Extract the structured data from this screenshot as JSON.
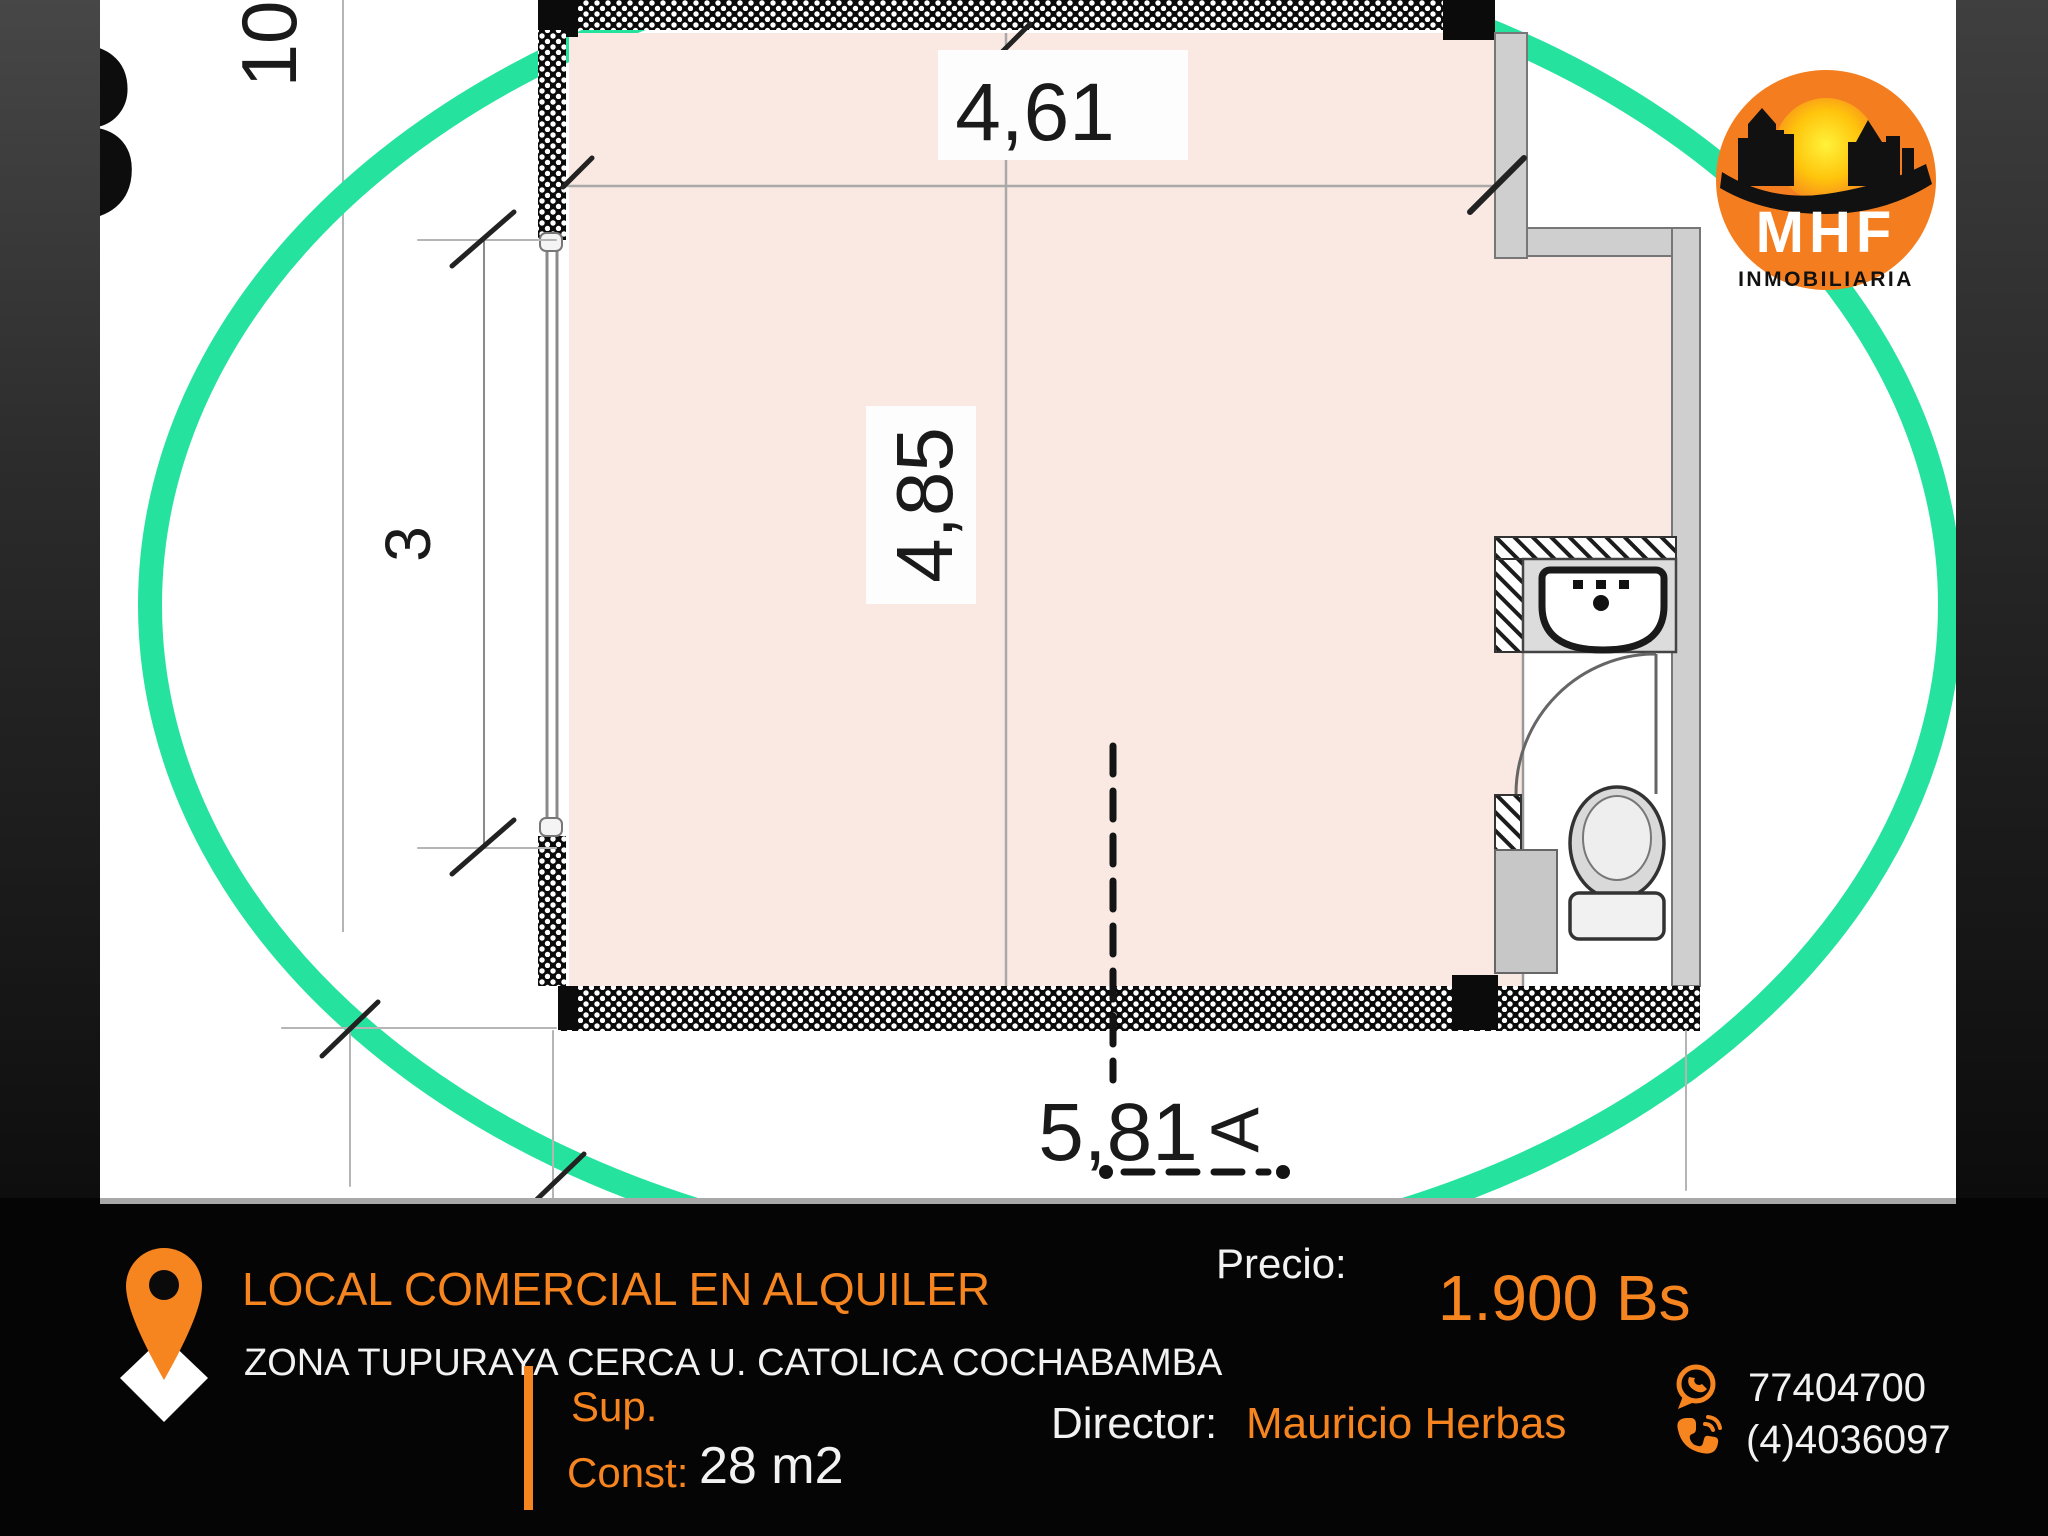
{
  "plan": {
    "dim_top": "4,61",
    "dim_room_height": "4,85",
    "dim_left_window": "3",
    "dim_left_tall": "10",
    "dim_bottom": "5,81",
    "section_marker": "A",
    "edge_glyph": "8"
  },
  "logo": {
    "brand": "MHF",
    "subtitle": "INMOBILIARIA"
  },
  "footer": {
    "title": "LOCAL COMERCIAL EN ALQUILER",
    "subtitle": "ZONA TUPURAYA CERCA U. CATOLICA COCHABAMBA",
    "price_label": "Precio:",
    "price_value": "1.900 Bs",
    "sup_label": "Sup.",
    "const_label": "Const:",
    "area_value": "28 m2",
    "director_label": "Director:",
    "director_name": "Mauricio Herbas",
    "phone_whatsapp": "77404700",
    "phone_landline": "(4)4036097"
  },
  "colors": {
    "accent_orange": "#F6841F",
    "circle_green": "#25E39E",
    "floor_pink": "#FAE9E2"
  }
}
